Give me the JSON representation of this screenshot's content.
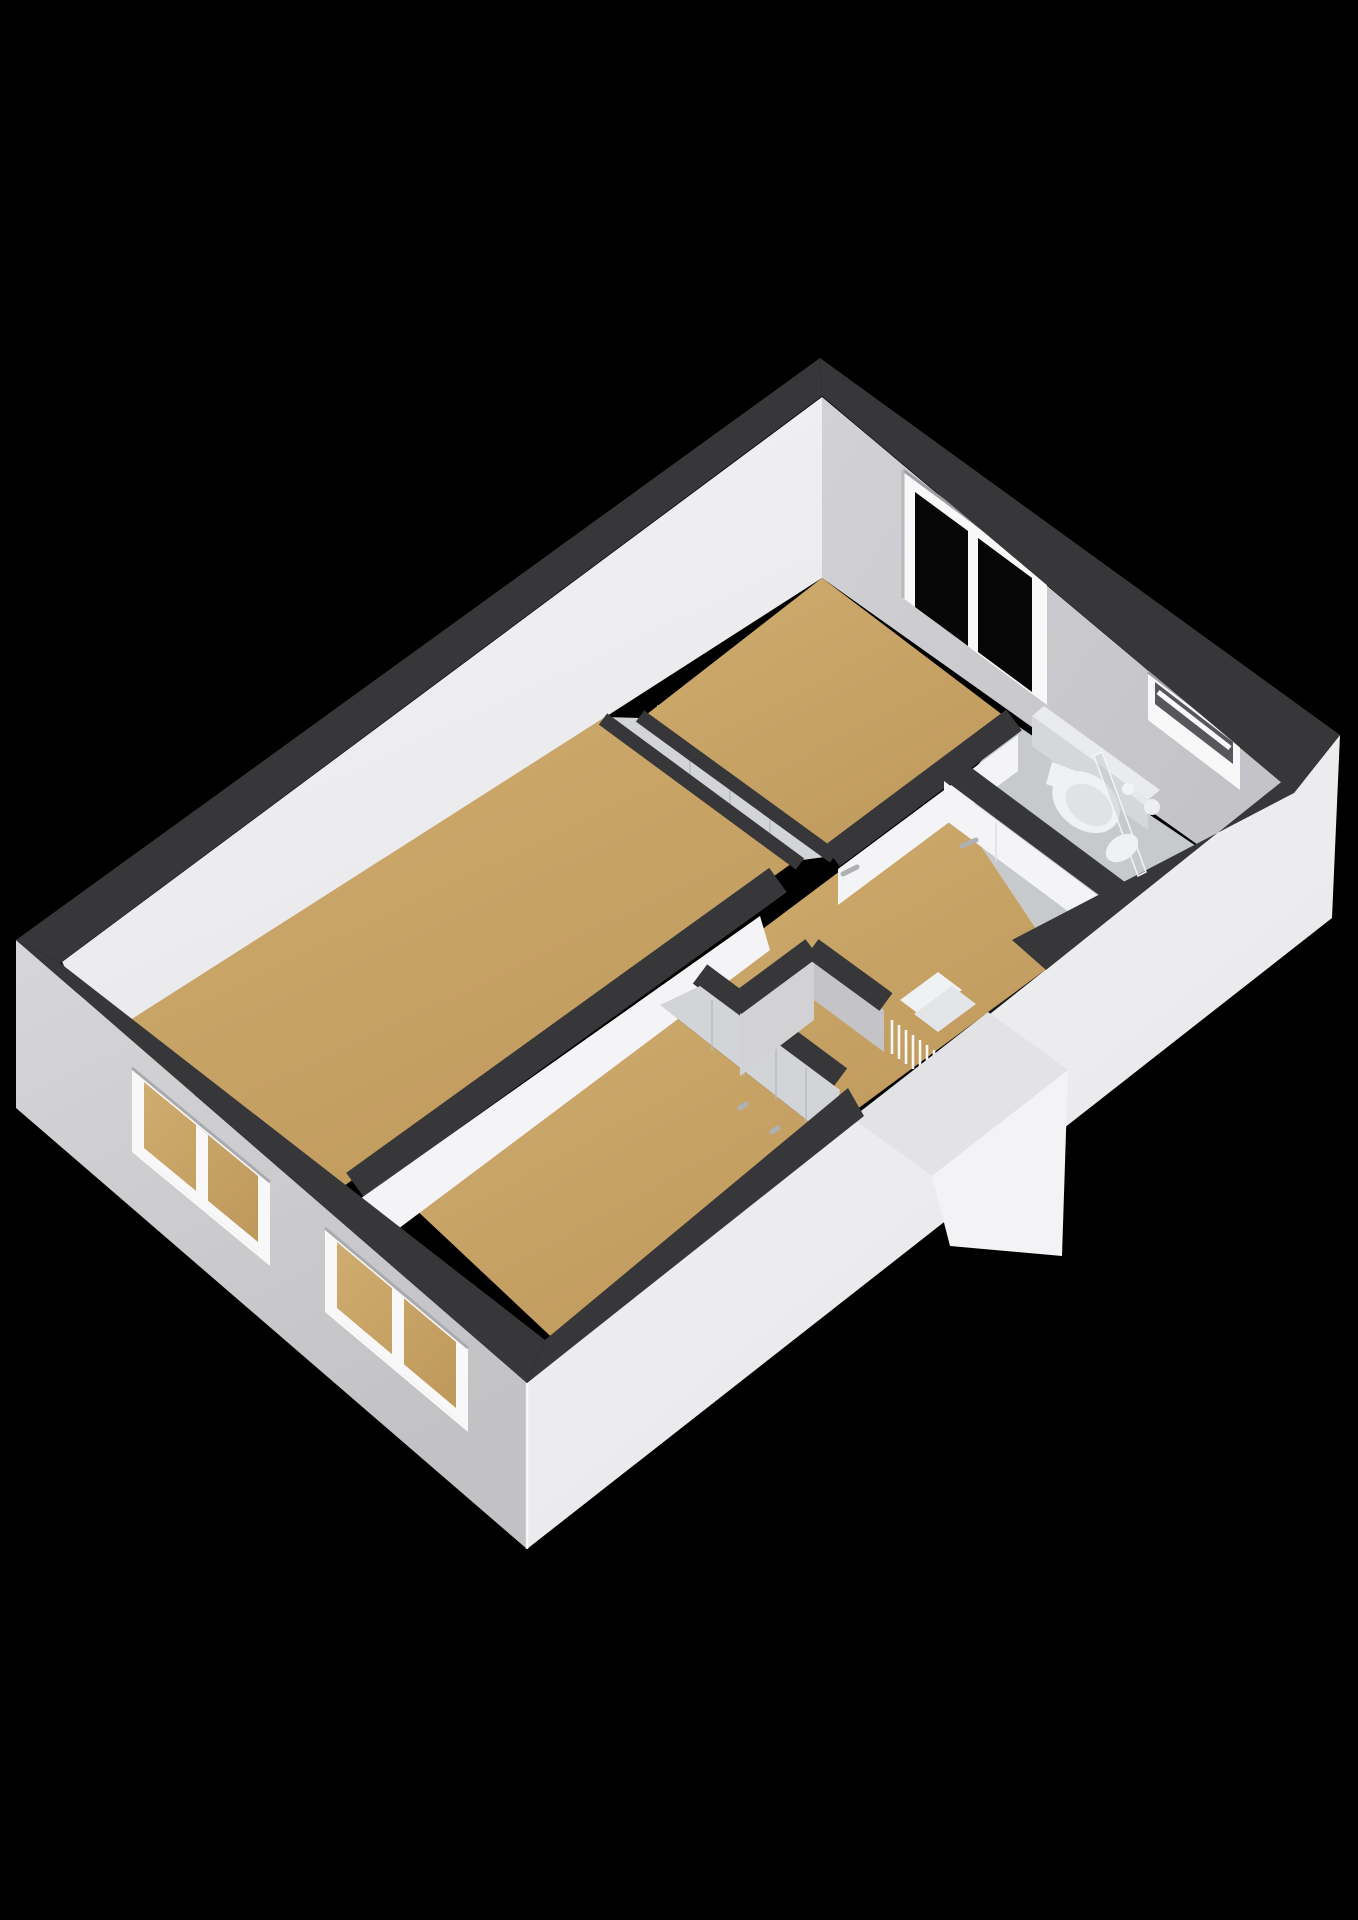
{
  "scene": {
    "kind": "3d-floorplan-isometric-render",
    "background": "#000000",
    "colors": {
      "bg": "#000000",
      "band": "#37373a",
      "extLeft": "#d6d6d8",
      "extLeftDark": "#c2c2c5",
      "extRight": "#f3f3f5",
      "extRightDark": "#e6e6e9",
      "intBright": "#f4f4f6",
      "intBrightDark": "#e8e8eb",
      "intGray": "#d2d2d5",
      "intGrayDark": "#c4c4c8",
      "floor": "#cfac6f",
      "floorDark": "#c09a5d",
      "bathFloor": "#c7cacd",
      "glass": "#060607",
      "frame": "#f8f8f9",
      "panel": "#d3d4d7",
      "fixture": "#f0f1f3",
      "stairShadow": "#1b1b1d",
      "screen": "rgba(196,202,208,0.5)",
      "handle": "#aeb0b4"
    },
    "rooms": [
      {
        "id": "bedroom-left",
        "floor_material": "wood"
      },
      {
        "id": "bedroom-top",
        "floor_material": "wood"
      },
      {
        "id": "bedroom-front",
        "floor_material": "wood"
      },
      {
        "id": "hallway",
        "floor_material": "wood"
      },
      {
        "id": "closet",
        "floor_material": "none"
      },
      {
        "id": "bathroom",
        "floor_material": "tile"
      }
    ],
    "windows": [
      {
        "id": "window-back-right",
        "panes": 2,
        "glazing": "dark"
      },
      {
        "id": "window-bathroom-slit",
        "panes": 1,
        "glazing": "frosted"
      },
      {
        "id": "window-front-left-a",
        "panes": 2,
        "glazing": "open-view"
      },
      {
        "id": "window-front-left-b",
        "panes": 2,
        "glazing": "open-view"
      }
    ],
    "fixtures": [
      "toilet",
      "wash-basin",
      "faucet",
      "shower-screen",
      "staircase",
      "stair-balusters",
      "sliding-closet-doors",
      "door-handle-hall",
      "door-handle-bathroom"
    ]
  }
}
